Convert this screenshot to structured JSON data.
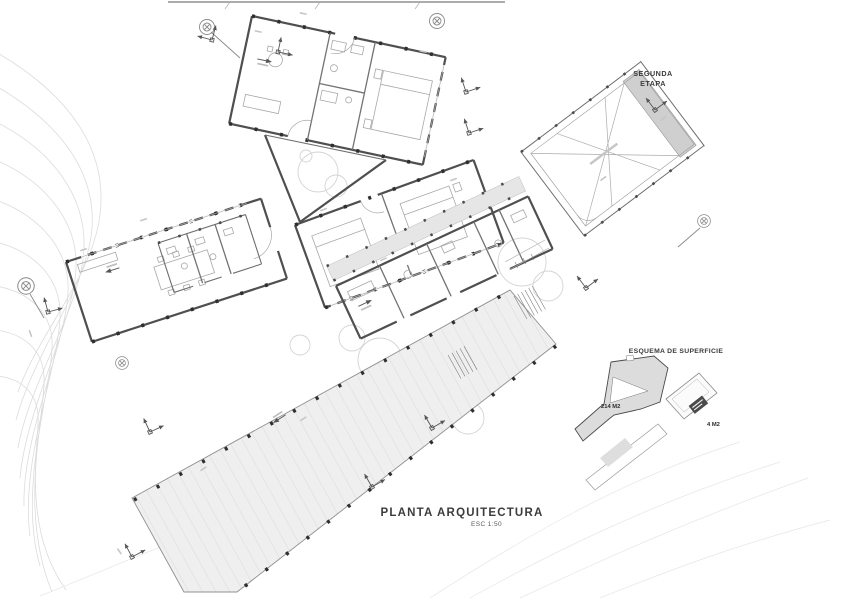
{
  "drawing": {
    "title": "PLANTA ARQUITECTURA",
    "scale": "ESC 1:50",
    "second_stage_label": {
      "line1": "SEGUNDA",
      "line2": "ETAPA"
    },
    "surface_scheme": {
      "title": "ESQUEMA DE SUPERFICIE",
      "main_area_label": "214 M2",
      "secondary_area_label": "4 M2"
    },
    "icons": {
      "tree": "tree-icon",
      "axis_marker": "axis-marker-icon",
      "access_arrow": "access-arrow-icon",
      "stairs": "stairs-icon"
    },
    "colors": {
      "paper": "#ffffff",
      "walls": "#4f4f4f",
      "contours": "#dcdcdc",
      "deck_fill": "#efefef",
      "walkway_fill": "#e6e6e6",
      "footprint_fill": "#dcdcdc",
      "label_box": "#4a4a4a"
    }
  }
}
